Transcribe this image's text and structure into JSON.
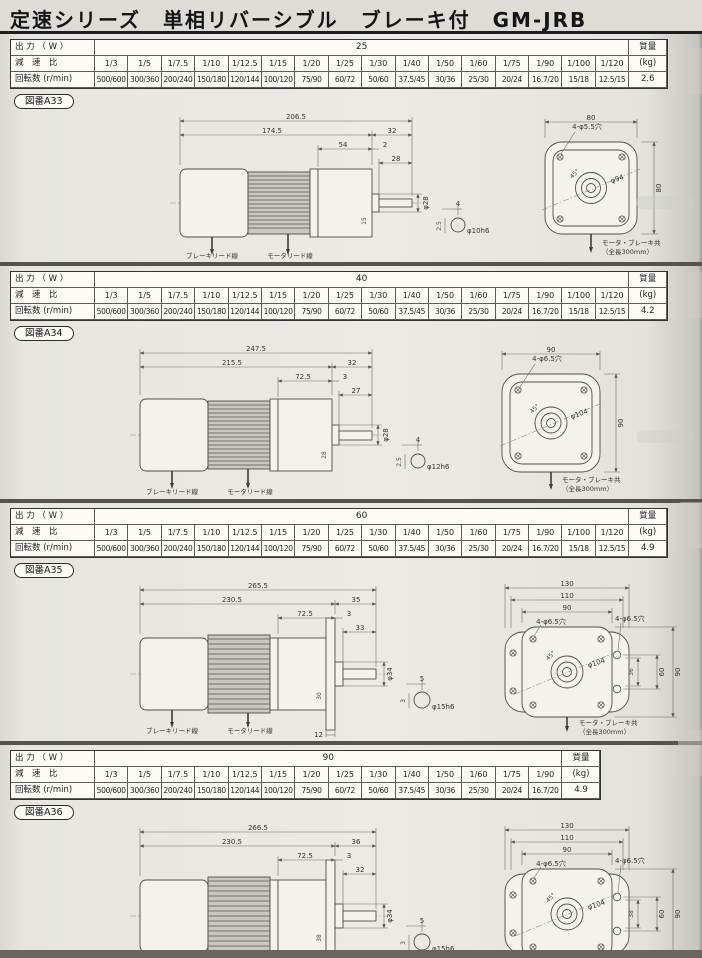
{
  "page": {
    "title": "定速シリーズ　単相リバーシブル　ブレーキ付　GM-JRB"
  },
  "labels": {
    "output": "出 力 （ W ）",
    "ratio": "減　速　比",
    "speed": "回転数 (r/min)",
    "mass": "質量",
    "mass_unit": "(kg)"
  },
  "sections": [
    {
      "fig": "図番A33",
      "output": "25",
      "mass": "2.6",
      "ratios": [
        "1/3",
        "1/5",
        "1/7.5",
        "1/10",
        "1/12.5",
        "1/15",
        "1/20",
        "1/25",
        "1/30",
        "1/40",
        "1/50",
        "1/60",
        "1/75",
        "1/90",
        "1/100",
        "1/120"
      ],
      "speeds": [
        "500/600",
        "300/360",
        "200/240",
        "150/180",
        "120/144",
        "100/120",
        "75/90",
        "60/72",
        "50/60",
        "37.5/45",
        "30/36",
        "25/30",
        "20/24",
        "16.7/20",
        "15/18",
        "12.5/15"
      ],
      "side": {
        "overall": "206.5",
        "body": "174.5",
        "tail": "32",
        "mid": "54",
        "gap": "2",
        "shaft_len": "28",
        "shaft_dia": "φ28",
        "boss": "15",
        "key_w": "4",
        "key_h": "2.5",
        "shaft_tol": "φ10h6",
        "brake_wire": "ブレーキリード線",
        "motor_wire": "モータリード線"
      },
      "rear": {
        "w": "80",
        "h": "80",
        "holes": "4-φ5.5穴",
        "circle": "φ94",
        "angle": "45°",
        "note1": "モータ・ブレーキ共",
        "note2": "（全長300mm）"
      }
    },
    {
      "fig": "図番A34",
      "output": "40",
      "mass": "4.2",
      "ratios": [
        "1/3",
        "1/5",
        "1/7.5",
        "1/10",
        "1/12.5",
        "1/15",
        "1/20",
        "1/25",
        "1/30",
        "1/40",
        "1/50",
        "1/60",
        "1/75",
        "1/90",
        "1/100",
        "1/120"
      ],
      "speeds": [
        "500/600",
        "300/360",
        "200/240",
        "150/180",
        "120/144",
        "100/120",
        "75/90",
        "60/72",
        "50/60",
        "37.5/45",
        "30/36",
        "25/30",
        "20/24",
        "16.7/20",
        "15/18",
        "12.5/15"
      ],
      "side": {
        "overall": "247.5",
        "body": "215.5",
        "tail": "32",
        "mid": "72.5",
        "gap": "3",
        "shaft_len": "27",
        "shaft_dia": "φ28",
        "boss": "28",
        "key_w": "4",
        "key_h": "2.5",
        "shaft_tol": "φ12h6",
        "brake_wire": "ブレーキリード線",
        "motor_wire": "モータリード線"
      },
      "rear": {
        "w": "90",
        "h": "90",
        "holes": "4-φ6.5穴",
        "circle": "φ104",
        "angle": "45°",
        "note1": "モータ・ブレーキ共",
        "note2": "（全長300mm）"
      }
    },
    {
      "fig": "図番A35",
      "output": "60",
      "mass": "4.9",
      "ratios": [
        "1/3",
        "1/5",
        "1/7.5",
        "1/10",
        "1/12.5",
        "1/15",
        "1/20",
        "1/25",
        "1/30",
        "1/40",
        "1/50",
        "1/60",
        "1/75",
        "1/90",
        "1/100",
        "1/120"
      ],
      "speeds": [
        "500/600",
        "300/360",
        "200/240",
        "150/180",
        "120/144",
        "100/120",
        "75/90",
        "60/72",
        "50/60",
        "37.5/45",
        "30/36",
        "25/30",
        "20/24",
        "16.7/20",
        "15/18",
        "12.5/15"
      ],
      "side": {
        "overall": "265.5",
        "body": "230.5",
        "tail": "35",
        "mid": "72.5",
        "gap": "3",
        "shaft_len": "33",
        "shaft_dia": "φ34",
        "boss": "30",
        "foot": "12",
        "key_w": "5",
        "key_h": "3",
        "shaft_tol": "φ15h6",
        "brake_wire": "ブレーキリード線",
        "motor_wire": "モータリード線"
      },
      "rear": {
        "w1": "130",
        "w2": "110",
        "w3": "90",
        "h1": "90",
        "h2": "60",
        "h3": "36",
        "holes": "4-φ6.5穴",
        "holes2": "4-φ6.5穴",
        "circle": "φ104",
        "angle": "45°",
        "note1": "モータ・ブレーキ共",
        "note2": "（全長300mm）"
      }
    },
    {
      "fig": "図番A36",
      "output": "90",
      "mass": "4.9",
      "ratios": [
        "1/3",
        "1/5",
        "1/7.5",
        "1/10",
        "1/12.5",
        "1/15",
        "1/20",
        "1/25",
        "1/30",
        "1/40",
        "1/50",
        "1/60",
        "1/75",
        "1/90"
      ],
      "speeds": [
        "500/600",
        "300/360",
        "200/240",
        "150/180",
        "120/144",
        "100/120",
        "75/90",
        "60/72",
        "50/60",
        "37.5/45",
        "30/36",
        "25/30",
        "20/24",
        "16.7/20"
      ],
      "side": {
        "overall": "266.5",
        "body": "230.5",
        "tail": "36",
        "mid": "72.5",
        "gap": "3",
        "shaft_len": "32",
        "shaft_dia": "φ34",
        "boss": "38",
        "foot": "12",
        "key_w": "5",
        "key_h": "3",
        "shaft_tol": "φ15h6",
        "brake_wire": "ブレーキリード線",
        "motor_wire": "モータリード線"
      },
      "rear": {
        "w1": "130",
        "w2": "110",
        "w3": "90",
        "h1": "90",
        "h2": "60",
        "h3": "38",
        "holes": "4-φ6.5穴",
        "holes2": "4-φ6.5穴",
        "circle": "φ104",
        "angle": "45°",
        "note1": "モータ・ブレーキ共",
        "note2": "（全長300mm）"
      }
    }
  ]
}
